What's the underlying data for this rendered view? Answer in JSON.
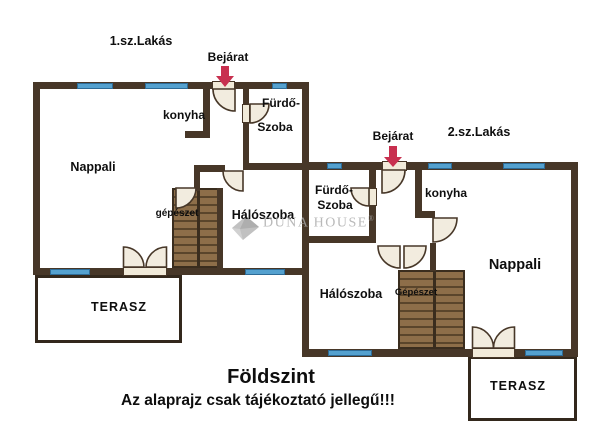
{
  "apartment1": {
    "title": "1.sz.Lakás",
    "entrance": "Bejárat",
    "rooms": {
      "living": "Nappali",
      "kitchen": "konyha",
      "bath_line1": "Fürdő-",
      "bath_line2": "Szoba",
      "bedroom": "Hálószoba",
      "utility": "gépészet",
      "terrace": "TERASZ"
    }
  },
  "apartment2": {
    "title": "2.sz.Lakás",
    "entrance": "Bejárat",
    "rooms": {
      "living": "Nappali",
      "kitchen": "konyha",
      "bath_line1": "Fürdő-",
      "bath_line2": "Szoba",
      "bedroom": "Hálószoba",
      "utility": "Gépészet",
      "terrace": "TERASZ"
    }
  },
  "footer": {
    "floor": "Földszint",
    "disclaimer": "Az alaprajz csak tájékoztató jellegű!!!"
  },
  "watermark": {
    "brand": "DUNA HOUSE",
    "registered": "®"
  },
  "colors": {
    "wall": "#473728",
    "window": "#54a1cf",
    "stairs": "#8d6e49",
    "door": "#f2ecdf",
    "arrow": "#c8304f",
    "text": "#0e0e0e",
    "watermark": "#a8a8a8"
  }
}
